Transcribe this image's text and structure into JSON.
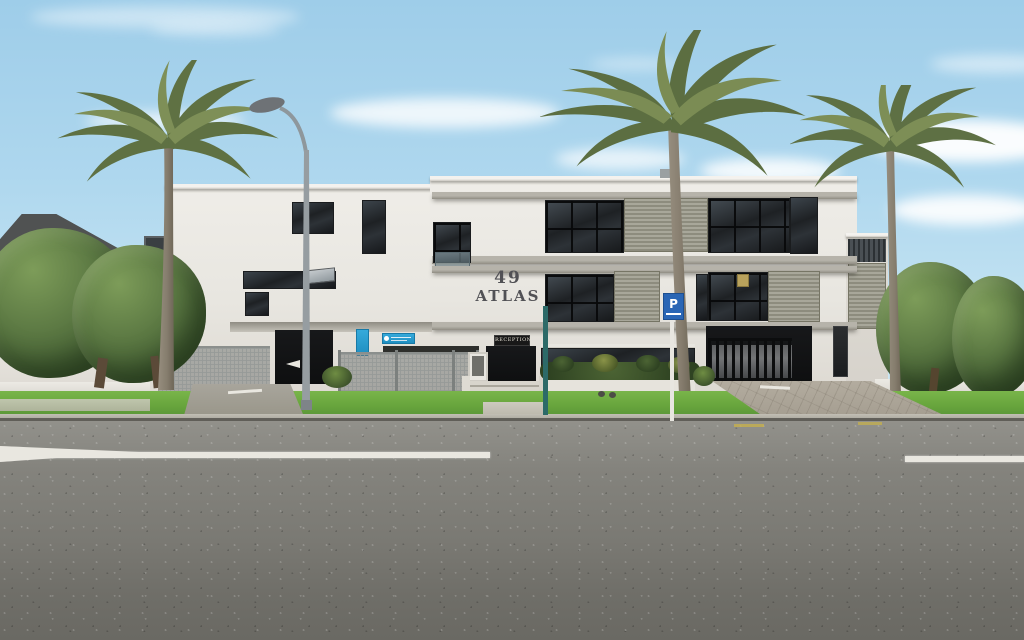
{
  "scene_label": "street-photo-of-apartment-building",
  "building": {
    "number": "49",
    "name": "ATLAS",
    "reception_sign": "RECEPTION"
  },
  "street": {
    "parking_sign_letter": "P"
  },
  "colors": {
    "sky": "#a6d2ea",
    "wall_white": "#e9e7e1",
    "band_gray": "#a9a69e",
    "window_dark": "#1e2124",
    "louver_gray": "#9a998c",
    "sign_cyan_blue": "#2aa0d0",
    "parking_sign_blue": "#2a66b5",
    "teal_pole": "#2c6a68",
    "grass_green": "#67a43c",
    "foliage_green": "#4c683a",
    "road_gray": "#7b7a74",
    "reception_sign_bg": "#181818"
  }
}
